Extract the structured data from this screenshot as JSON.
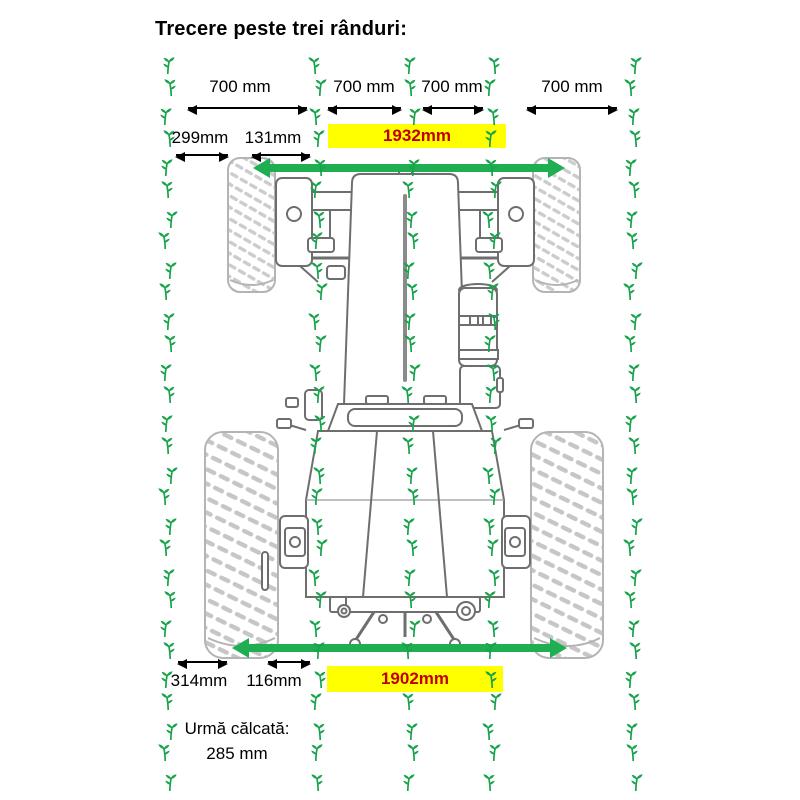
{
  "title": "Trecere peste trei rânduri:",
  "row_spacing": [
    "700 mm",
    "700 mm",
    "700 mm",
    "700 mm"
  ],
  "front_dims": {
    "left_offset": "299mm",
    "right_offset": "131mm",
    "track_width": "1932mm"
  },
  "rear_dims": {
    "left_offset": "314mm",
    "right_offset": "116mm",
    "track_width": "1902mm"
  },
  "footnote": {
    "label": "Urmă călcată:",
    "value": "285 mm"
  },
  "colors": {
    "plant": "#17a34b",
    "arrow_green": "#1fae52",
    "highlight": "#ffff00",
    "track_text": "#c00000"
  },
  "plants": {
    "columns": [
      168,
      318,
      411,
      492,
      633
    ],
    "row_start": 56,
    "row_step": 25.6,
    "row_count": 29,
    "skip": [
      [
        2,
        3
      ],
      [
        2,
        24
      ]
    ],
    "jitter_x": [
      0,
      3,
      -3,
      2,
      -2
    ],
    "jitter_y": [
      0,
      -4
    ]
  }
}
